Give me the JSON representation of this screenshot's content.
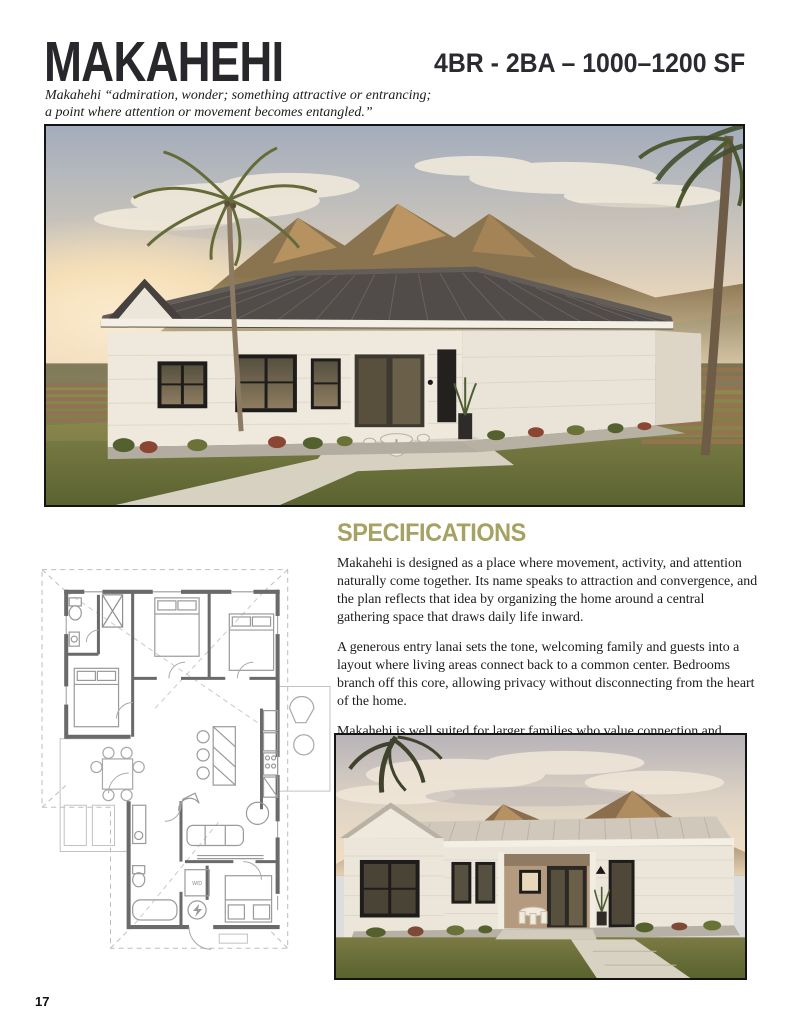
{
  "header": {
    "title": "MAKAHEHI",
    "spec_line": "4BR - 2BA – 1000–1200 SF",
    "subtitle_line1": "Makahehi “admiration, wonder; something attractive or entrancing;",
    "subtitle_line2": "a point where attention or movement becomes entangled.”"
  },
  "specifications": {
    "heading": "SPECIFICATIONS",
    "paragraphs": [
      "Makahehi is designed as a place where movement, activity, and attention naturally come together. Its name speaks to attraction and convergence, and the plan reflects that idea by organizing the home around a central gathering space that draws daily life inward.",
      "A generous entry lanai sets the tone, welcoming family and guests into a layout where living areas connect back to a common center. Bedrooms branch off this core, allowing privacy without disconnecting from the heart of the home.",
      "Makahehi is well suited for larger families who value connection and shared experience. It is a home shaped around its piko, where people naturally gather and life moves together."
    ]
  },
  "floor_plan": {
    "wd_label": "W/D"
  },
  "footer": {
    "page_number": "17"
  },
  "colors": {
    "accent": "#a5a263",
    "ink": "#1c1c1e",
    "photo_border": "#141414"
  }
}
